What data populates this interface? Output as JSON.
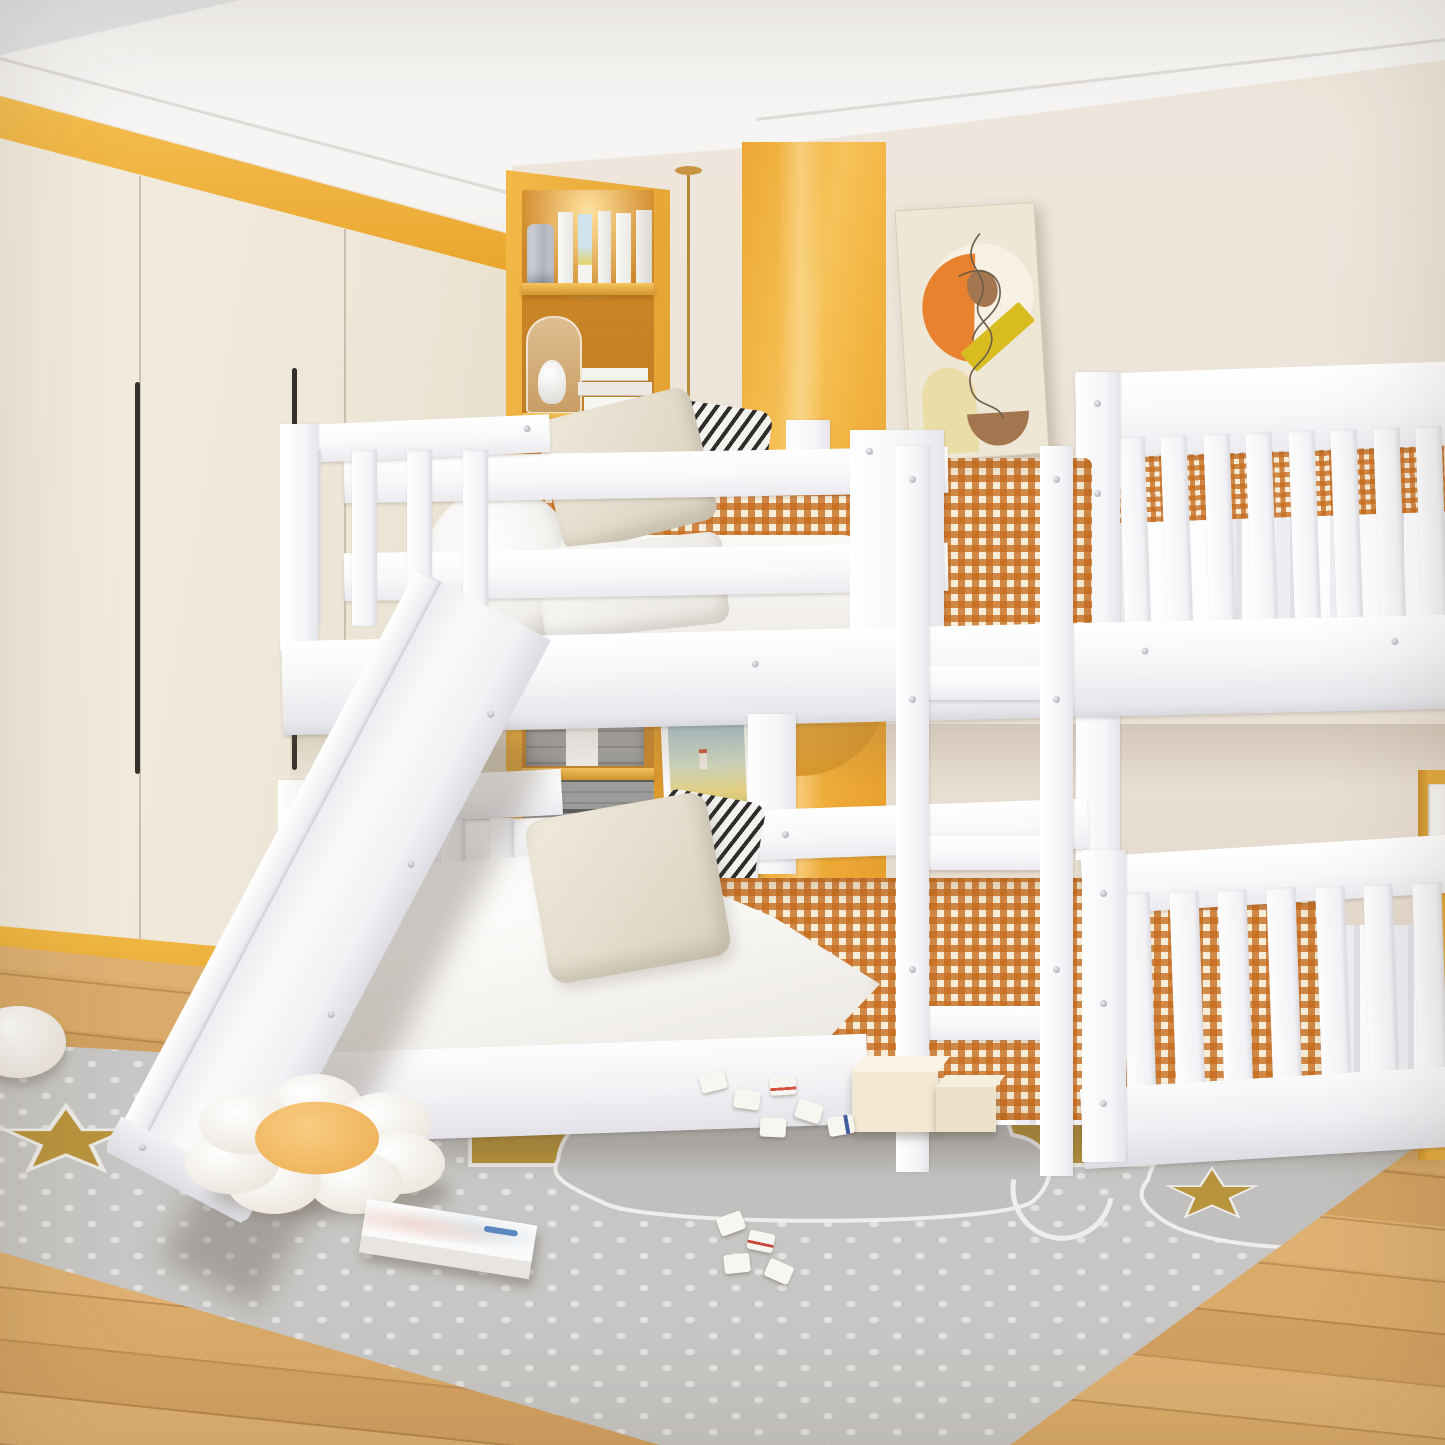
{
  "meta": {
    "title": "Kids bedroom with white twin-over-twin bunk bed with slide",
    "type": "product lifestyle photograph",
    "visible_text": "none"
  },
  "palette": {
    "ceiling": "#f3f2f0",
    "wall": "#ebe2d7",
    "wardrobe": "#efe8da",
    "accent_yellow": "#f0b23c",
    "glossy_panel": "#f3b747",
    "bed_white": "#fbfbfc",
    "gingham_orange": "#c66c1e",
    "bedding_white": "#f8f6f3",
    "pillow_beige": "#e6dfd0",
    "stripe_black": "#2e2d2b",
    "rug_gray": "#c7c6c4",
    "rug_dot": "#e6e5e3",
    "rug_gold": "#b8943d",
    "wood_floor": "#d6a765",
    "nightstand_yellow": "#e2a93e",
    "poster_bg": "#efe7d6",
    "poster_orange": "#e8822f",
    "poster_yellow": "#d9bd20",
    "poster_brown": "#a3764f"
  },
  "scene": {
    "ceiling": {
      "label": "white ceiling with crown molding"
    },
    "wall": {
      "label": "cream back wall"
    },
    "wardrobe": {
      "label": "cream floor-to-ceiling wardrobe with yellow trim",
      "doors": 3,
      "handles": 2
    },
    "niche": {
      "label": "recessed yellow display shelving with warm lighting",
      "shelves": 5,
      "items": [
        "white hardcover books",
        "glass lantern",
        "glass dome with white figurine",
        "stack of white books",
        "green potted plant in gray crate",
        "white bottle vase",
        "gray storage drawers",
        "wicker basket"
      ]
    },
    "accent_panel": {
      "label": "glossy amber feature panel"
    },
    "wall_circle": {
      "label": "round amber wall decor"
    },
    "poster": {
      "label": "abstract line-art poster",
      "shapes": [
        "orange half disc",
        "brown oval",
        "yellow diagonal bar",
        "beige arch",
        "brown bowl",
        "continuous line doodle"
      ]
    },
    "picture": {
      "label": "framed village painting leaning against the wall"
    },
    "pendant": {
      "label": "brass pendant cord"
    },
    "bed": {
      "label": "white twin-over-twin wood bunk bed with guardrails, ladder and slide",
      "top_bunk": {
        "guardrail_planks": 2,
        "left_panel_slats": 4,
        "headboard_slats": 8,
        "pillows": [
          "beige pillow",
          "white pillow",
          "black-white striped pillow",
          "rolled white duvet"
        ],
        "bedding": [
          "orange gingham comforter",
          "white duvet"
        ]
      },
      "bottom_bunk": {
        "left_panel_slats": 5,
        "footboard_slats": 7,
        "pillows": [
          "beige pillow",
          "black-white striped pillow"
        ],
        "bedding": [
          "orange gingham comforter",
          "white duvet",
          "white fitted sheet"
        ]
      },
      "ladder": {
        "rungs": 3
      },
      "slide": {
        "label": "angled white slide with side rails"
      }
    },
    "nightstand": {
      "label": "yellow nightstand with white drawer"
    },
    "rug": {
      "label": "gray polka-dot play rug",
      "motifs": [
        "gold clouds",
        "gray outlined clouds",
        "gold stars",
        "white outline stars",
        "white outline moon"
      ]
    },
    "floor": {
      "label": "light oak plank floor"
    },
    "toys": {
      "flower_cushion": "plush flower cushion with peach center",
      "plush": "small white plush at left edge",
      "book": "picture book lying on the rug",
      "blocks": "wooden cube blocks",
      "tiles": "scattered game tiles"
    }
  }
}
